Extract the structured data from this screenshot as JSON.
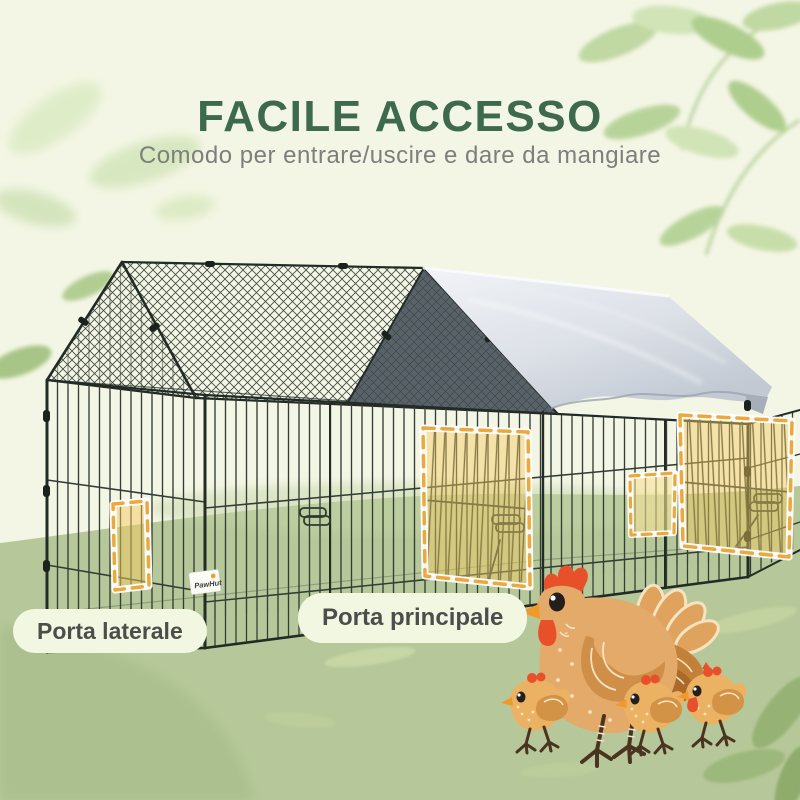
{
  "header": {
    "title": "FACILE ACCESSO",
    "subtitle": "Comodo per entrare/uscire e dare da mangiare"
  },
  "callouts": {
    "side_door": "Porta laterale",
    "main_door": "Porta principale"
  },
  "brand": {
    "logo_text": "PawHut"
  },
  "scene": {
    "product": "outdoor-chicken-run-cage",
    "cover": "gray-tarp-roof-cover",
    "highlighted_openings": 4,
    "animals": {
      "hens": 1,
      "chicks": 3
    },
    "decor": [
      "leaves-top-left",
      "leaves-top-right",
      "leaves-bottom-right",
      "grass-blades"
    ]
  },
  "colors": {
    "title_green": "#3d6a4d",
    "subtitle_gray": "#7c7f7a",
    "bg_cream": "#f4f6e5",
    "grass_green": "#b6c899",
    "highlight_orange": "#eba93d",
    "highlight_fill": "#f3c95f",
    "tarp_gray": "#d7dce3",
    "gable_gray": "#59626c",
    "wire_dark": "#2c362f",
    "pill_bg": "#f2f7e2",
    "pill_text": "#4b4f4c",
    "hen_body": "#e4aa6a",
    "chick_body": "#ecb263",
    "comb_red": "#e8502a"
  }
}
